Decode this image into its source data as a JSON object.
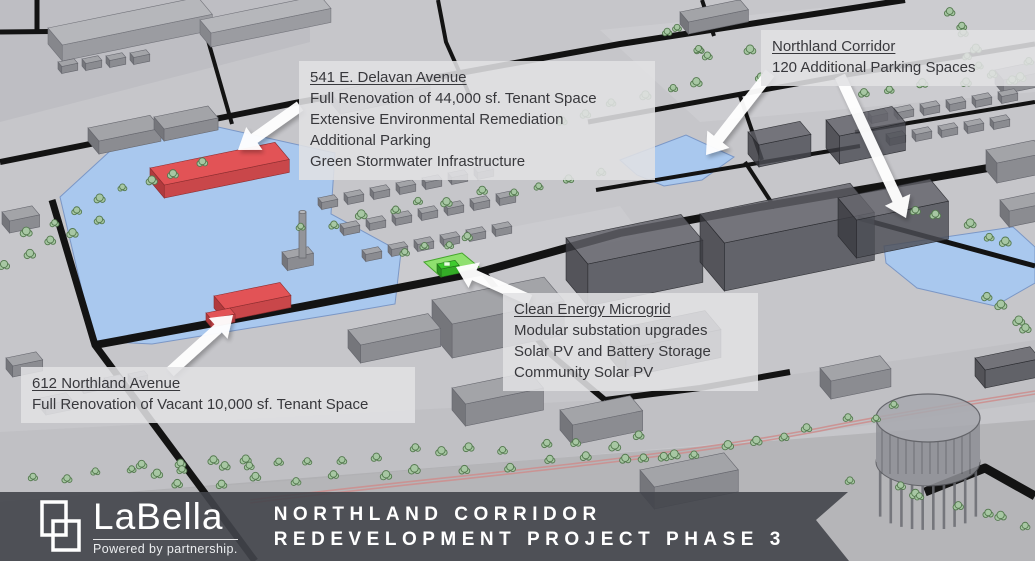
{
  "page": {
    "title": "Northland Corridor Redevelopment Project Phase 3"
  },
  "callouts": {
    "delavan": {
      "title": "541 E. Delavan Avenue",
      "lines": [
        "Full Renovation of 44,000 sf. Tenant Space",
        "Extensive Environmental Remediation",
        "Additional Parking",
        "Green Stormwater Infrastructure"
      ]
    },
    "northland_corridor": {
      "title": "Northland Corridor",
      "lines": [
        "120 Additional Parking Spaces"
      ]
    },
    "clean_energy_microgrid": {
      "title": "Clean Energy Microgrid",
      "lines": [
        "Modular substation upgrades",
        "Solar PV and Battery Storage",
        "Community Solar PV"
      ]
    },
    "northland_612": {
      "title": "612 Northland Avenue",
      "lines": [
        "Full Renovation of Vacant 10,000 sf. Tenant Space"
      ]
    }
  },
  "banner": {
    "brand": "LaBella",
    "tagline": "Powered by partnership.",
    "title_line1": "NORTHLAND CORRIDOR",
    "title_line2": "REDEVELOPMENT PROJECT PHASE 3"
  },
  "map": {
    "colors": {
      "ground": "#c6c6ca",
      "ground_dark": "#bcbcc0",
      "ground_light": "#d0d0d4",
      "road": "#131313",
      "parcel_blue": "#a9c8ee",
      "parcel_blue_edge": "#7b97c6",
      "building_red_top": "#e25356",
      "building_red_front": "#b13a3d",
      "building_red_side": "#c9474a",
      "building_red_edge": "#8c2d2f",
      "building_green": "#3ecb2e",
      "green_pad": "#8fe06f",
      "tree_fill": "#a7c7a3",
      "tree_edge": "#54794f",
      "railway": "#cc8f8f",
      "arrow": "#ffffff",
      "banner": "#42454b",
      "callout_bg": "#e1e1e4"
    }
  }
}
